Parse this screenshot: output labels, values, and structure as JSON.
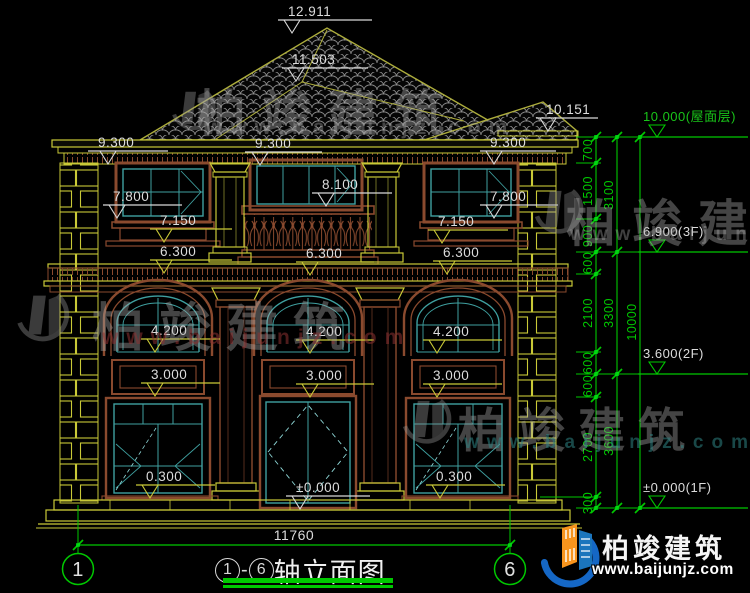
{
  "colors": {
    "yellow": "#C9C937",
    "marker_white": "#D8D8D8",
    "text": "#DCDCDC",
    "green": "#00C800",
    "grip": "#00E81C",
    "brown": "#8A4A2E",
    "teal": "#3FA0A0",
    "roof": "#ADAD3C"
  },
  "title": {
    "axis_start": "1",
    "separator": "-",
    "axis_end": "6",
    "name": "轴立面图"
  },
  "watermark": {
    "brand": "柏竣建筑",
    "url": "www.baijunjz.com"
  },
  "footer": {
    "brand": "柏竣建筑",
    "url": "www.baijunjz.com"
  },
  "annotations": {
    "building_markers": [
      {
        "label": "12.911",
        "x1": 278,
        "x2": 372,
        "y": 20,
        "ax": 292,
        "c": "w"
      },
      {
        "label": "11.503",
        "x1": 282,
        "x2": 368,
        "y": 68,
        "ax": 296,
        "c": "w"
      },
      {
        "label": "10.151",
        "x1": 536,
        "x2": 598,
        "y": 118,
        "ax": 548,
        "c": "w"
      },
      {
        "label": "9.300",
        "x1": 88,
        "x2": 168,
        "y": 151,
        "ax": 108,
        "c": "w"
      },
      {
        "label": "9.300",
        "x1": 245,
        "x2": 322,
        "y": 152,
        "ax": 260,
        "c": "w"
      },
      {
        "label": "9.300",
        "x1": 480,
        "x2": 556,
        "y": 151,
        "ax": 494,
        "c": "w"
      },
      {
        "label": "8.100",
        "x1": 312,
        "x2": 392,
        "y": 193,
        "ax": 326,
        "c": "w"
      },
      {
        "label": "7.800",
        "x1": 103,
        "x2": 182,
        "y": 205,
        "ax": 117,
        "c": "w"
      },
      {
        "label": "7.800",
        "x1": 480,
        "x2": 558,
        "y": 205,
        "ax": 494,
        "c": "w"
      },
      {
        "label": "7.150",
        "x1": 150,
        "x2": 232,
        "y": 229,
        "ax": 164,
        "c": "y"
      },
      {
        "label": "7.150",
        "x1": 428,
        "x2": 508,
        "y": 230,
        "ax": 442,
        "c": "y"
      },
      {
        "label": "6.300",
        "x1": 150,
        "x2": 232,
        "y": 260,
        "ax": 164,
        "c": "y"
      },
      {
        "label": "6.300",
        "x1": 296,
        "x2": 374,
        "y": 262,
        "ax": 310,
        "c": "y"
      },
      {
        "label": "6.300",
        "x1": 433,
        "x2": 512,
        "y": 261,
        "ax": 447,
        "c": "y"
      },
      {
        "label": "4.200",
        "x1": 141,
        "x2": 220,
        "y": 339,
        "ax": 155,
        "c": "y"
      },
      {
        "label": "4.200",
        "x1": 296,
        "x2": 374,
        "y": 340,
        "ax": 310,
        "c": "y"
      },
      {
        "label": "4.200",
        "x1": 423,
        "x2": 502,
        "y": 340,
        "ax": 437,
        "c": "y"
      },
      {
        "label": "3.000",
        "x1": 141,
        "x2": 220,
        "y": 383,
        "ax": 155,
        "c": "y"
      },
      {
        "label": "3.000",
        "x1": 296,
        "x2": 374,
        "y": 384,
        "ax": 310,
        "c": "y"
      },
      {
        "label": "3.000",
        "x1": 423,
        "x2": 502,
        "y": 384,
        "ax": 437,
        "c": "y"
      },
      {
        "label": "0.300",
        "x1": 136,
        "x2": 215,
        "y": 485,
        "ax": 150,
        "c": "y"
      },
      {
        "label": "0.300",
        "x1": 426,
        "x2": 505,
        "y": 485,
        "ax": 440,
        "c": "y"
      },
      {
        "label": "±0.000",
        "x1": 286,
        "x2": 370,
        "y": 496,
        "ax": 300,
        "c": "w"
      }
    ],
    "chain": {
      "columns": [
        {
          "x": 596,
          "ticks": [
            137,
            163,
            219,
            252,
            274,
            352,
            374,
            397,
            497,
            508
          ],
          "dims": [
            [
              "700",
              150
            ],
            [
              "1500",
              191
            ],
            [
              "900",
              236
            ],
            [
              "600",
              263
            ],
            [
              "2100",
              313
            ],
            [
              "600",
              363
            ],
            [
              "600",
              386
            ],
            [
              "2700",
              447
            ],
            [
              "300",
              503
            ]
          ]
        },
        {
          "x": 617,
          "ticks": [
            137,
            252,
            374,
            508
          ],
          "dims": [
            [
              "3100",
              195
            ],
            [
              "3300",
              313
            ],
            [
              "3600",
              441
            ]
          ]
        },
        {
          "x": 640,
          "ticks": [
            137,
            508
          ],
          "dims": [
            [
              "10000",
              322
            ]
          ]
        }
      ],
      "extensions": [
        {
          "y": 137,
          "x1": 576,
          "x2": 648
        },
        {
          "y": 163,
          "x1": 576,
          "x2": 601
        },
        {
          "y": 219,
          "x1": 576,
          "x2": 601
        },
        {
          "y": 252,
          "x1": 576,
          "x2": 648
        },
        {
          "y": 274,
          "x1": 576,
          "x2": 601
        },
        {
          "y": 352,
          "x1": 576,
          "x2": 601
        },
        {
          "y": 374,
          "x1": 576,
          "x2": 648
        },
        {
          "y": 397,
          "x1": 576,
          "x2": 601
        },
        {
          "y": 497,
          "x1": 540,
          "x2": 601
        },
        {
          "y": 508,
          "x1": 576,
          "x2": 648
        }
      ],
      "levels": [
        {
          "label": "10.000(屋面层)",
          "y": 137,
          "green": true
        },
        {
          "label": "6.900(3F)",
          "y": 252,
          "green": false
        },
        {
          "label": "3.600(2F)",
          "y": 374,
          "green": false
        },
        {
          "label": "±0.000(1F)",
          "y": 508,
          "green": false
        }
      ]
    },
    "bottom": {
      "dim": "11760",
      "axis_left": "1",
      "axis_right": "6"
    }
  }
}
